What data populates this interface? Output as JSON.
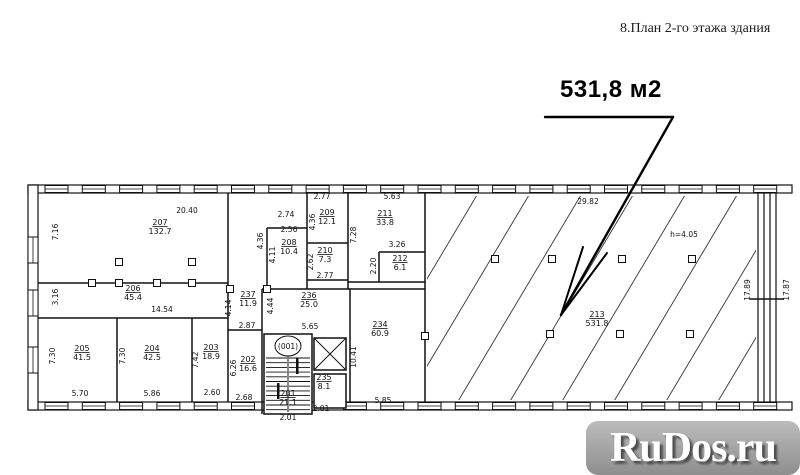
{
  "title": "8.План 2-го этажа здания",
  "callout": {
    "area_label": "531,8 м2"
  },
  "watermark": {
    "text": "RuDos.ru"
  },
  "plan": {
    "stair_badge": "(001)",
    "rooms": [
      {
        "number": "207",
        "area": "132.7",
        "x": 160,
        "y": 225
      },
      {
        "number": "206",
        "area": "45.4",
        "x": 133,
        "y": 291
      },
      {
        "number": "205",
        "area": "41.5",
        "x": 82,
        "y": 351
      },
      {
        "number": "204",
        "area": "42.5",
        "x": 152,
        "y": 351
      },
      {
        "number": "203",
        "area": "18.9",
        "x": 211,
        "y": 350
      },
      {
        "number": "202",
        "area": "16.6",
        "x": 248,
        "y": 362
      },
      {
        "number": "237",
        "area": "11.9",
        "x": 248,
        "y": 297
      },
      {
        "number": "236",
        "area": "25.0",
        "x": 309,
        "y": 298
      },
      {
        "number": "208",
        "area": "10.4",
        "x": 289,
        "y": 245
      },
      {
        "number": "209",
        "area": "12.1",
        "x": 327,
        "y": 215
      },
      {
        "number": "210",
        "area": "7.3",
        "x": 325,
        "y": 253
      },
      {
        "number": "211",
        "area": "33.8",
        "x": 385,
        "y": 216
      },
      {
        "number": "212",
        "area": "6.1",
        "x": 400,
        "y": 261
      },
      {
        "number": "234",
        "area": "60.9",
        "x": 380,
        "y": 327
      },
      {
        "number": "235",
        "area": "8.1",
        "x": 324,
        "y": 380
      },
      {
        "number": "201",
        "area": "21.1",
        "x": 288,
        "y": 396
      },
      {
        "number": "213",
        "area": "531.8",
        "x": 597,
        "y": 317
      }
    ],
    "dimensions": [
      {
        "text": "20.40",
        "x": 187,
        "y": 213,
        "vertical": false
      },
      {
        "text": "7.16",
        "x": 58,
        "y": 232,
        "vertical": true
      },
      {
        "text": "3.16",
        "x": 58,
        "y": 297,
        "vertical": true
      },
      {
        "text": "14.54",
        "x": 162,
        "y": 312,
        "vertical": false
      },
      {
        "text": "7.30",
        "x": 55,
        "y": 356,
        "vertical": true
      },
      {
        "text": "5.70",
        "x": 80,
        "y": 396,
        "vertical": false
      },
      {
        "text": "7.30",
        "x": 125,
        "y": 356,
        "vertical": true
      },
      {
        "text": "5.86",
        "x": 152,
        "y": 396,
        "vertical": false
      },
      {
        "text": "7.42",
        "x": 198,
        "y": 360,
        "vertical": true
      },
      {
        "text": "2.60",
        "x": 212,
        "y": 395,
        "vertical": false
      },
      {
        "text": "6.26",
        "x": 236,
        "y": 368,
        "vertical": true
      },
      {
        "text": "2.68",
        "x": 244,
        "y": 400,
        "vertical": false
      },
      {
        "text": "4.14",
        "x": 231,
        "y": 308,
        "vertical": true
      },
      {
        "text": "2.87",
        "x": 247,
        "y": 328,
        "vertical": false
      },
      {
        "text": "4.44",
        "x": 273,
        "y": 306,
        "vertical": true
      },
      {
        "text": "5.65",
        "x": 310,
        "y": 329,
        "vertical": false
      },
      {
        "text": "2.74",
        "x": 286,
        "y": 217,
        "vertical": false
      },
      {
        "text": "2.56",
        "x": 289,
        "y": 232,
        "vertical": false
      },
      {
        "text": "4.36",
        "x": 263,
        "y": 241,
        "vertical": true
      },
      {
        "text": "4.11",
        "x": 275,
        "y": 255,
        "vertical": true
      },
      {
        "text": "2.77",
        "x": 322,
        "y": 199,
        "vertical": false
      },
      {
        "text": "4.36",
        "x": 315,
        "y": 222,
        "vertical": true
      },
      {
        "text": "2.62",
        "x": 313,
        "y": 262,
        "vertical": true
      },
      {
        "text": "2.77",
        "x": 325,
        "y": 278,
        "vertical": false
      },
      {
        "text": "5.63",
        "x": 392,
        "y": 199,
        "vertical": false
      },
      {
        "text": "7.28",
        "x": 356,
        "y": 235,
        "vertical": true
      },
      {
        "text": "3.26",
        "x": 397,
        "y": 247,
        "vertical": false
      },
      {
        "text": "2.20",
        "x": 376,
        "y": 266,
        "vertical": true
      },
      {
        "text": "10.41",
        "x": 356,
        "y": 357,
        "vertical": true
      },
      {
        "text": "5.85",
        "x": 383,
        "y": 403,
        "vertical": false
      },
      {
        "text": "29.82",
        "x": 588,
        "y": 204,
        "vertical": false
      },
      {
        "text": "h=4.05",
        "x": 684,
        "y": 237,
        "vertical": false
      },
      {
        "text": "17.89",
        "x": 750,
        "y": 290,
        "vertical": true
      },
      {
        "text": "17.87",
        "x": 789,
        "y": 290,
        "vertical": true
      },
      {
        "text": "2.01",
        "x": 288,
        "y": 420,
        "vertical": false
      },
      {
        "text": "2.01",
        "x": 321,
        "y": 411,
        "vertical": false
      }
    ]
  }
}
